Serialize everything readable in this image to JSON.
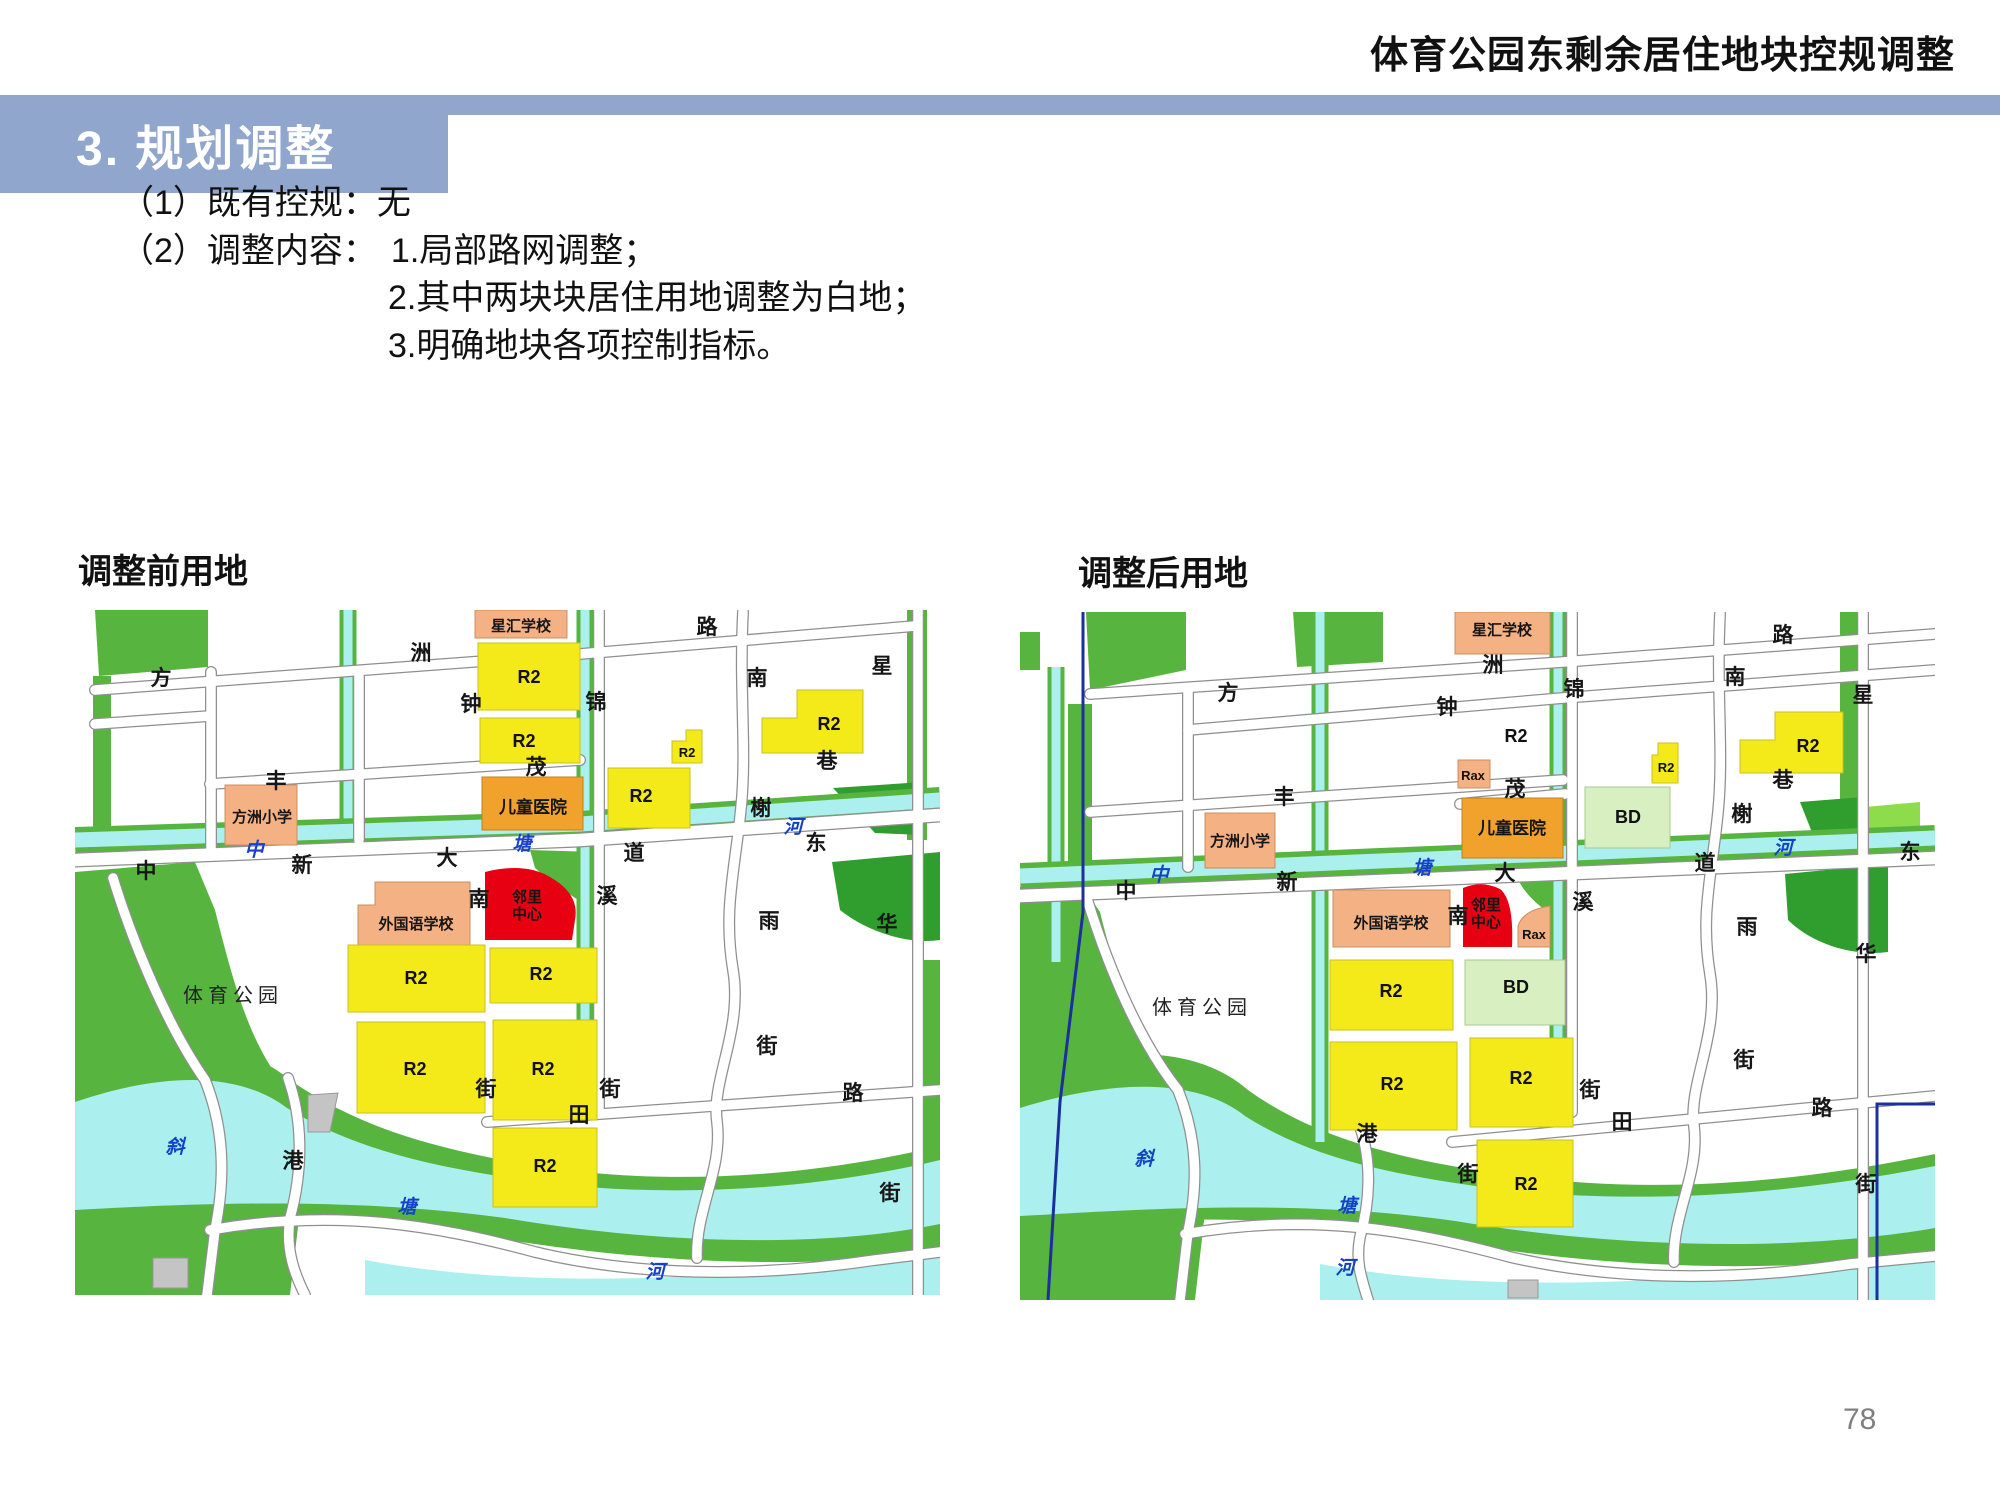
{
  "header": {
    "doc_title": "体育公园东剩余居住地块控规调整"
  },
  "section_banner": {
    "title": "3. 规划调整"
  },
  "body": {
    "line1": "（1）既有控规：无",
    "line2_prefix": "（2）调整内容：",
    "item1": "1.局部路网调整；",
    "item2": "2.其中两块块居住用地调整为白地；",
    "item3": "3.明确地块各项控制指标。"
  },
  "page_number": "78",
  "colors": {
    "banner_blue": "#90A6CC",
    "zone_residential_yellow": "#F4EA1A",
    "zone_school_orange": "#F4B183",
    "zone_hospital_amber": "#F0A22D",
    "zone_neighborhood_red": "#E60012",
    "zone_bd_pale_green": "#D8EFC2",
    "park_green": "#57B53F",
    "water_cyan": "#ABF0EF",
    "boundary_blue": "#1C2F9E"
  },
  "maps": {
    "before": {
      "caption": "调整前用地",
      "labels": [
        {
          "t": "方",
          "x": 86,
          "y": 75,
          "cls": "road-label",
          "name": "road-name-label"
        },
        {
          "t": "洲",
          "x": 346,
          "y": 50,
          "cls": "road-label",
          "name": "road-name-label"
        },
        {
          "t": "路",
          "x": 632,
          "y": 24,
          "cls": "road-label",
          "name": "road-name-label"
        },
        {
          "t": "南",
          "x": 682,
          "y": 75,
          "cls": "road-label",
          "name": "road-name-label"
        },
        {
          "t": "星",
          "x": 807,
          "y": 63,
          "cls": "road-label",
          "name": "road-name-label"
        },
        {
          "t": "钟",
          "x": 396,
          "y": 101,
          "cls": "road-label",
          "name": "road-name-label"
        },
        {
          "t": "锦",
          "x": 521,
          "y": 99,
          "cls": "road-label",
          "name": "road-name-label"
        },
        {
          "t": "丰",
          "x": 201,
          "y": 178,
          "cls": "road-label",
          "name": "road-name-label"
        },
        {
          "t": "茂",
          "x": 461,
          "y": 164,
          "cls": "road-label",
          "name": "road-name-label"
        },
        {
          "t": "巷",
          "x": 752,
          "y": 158,
          "cls": "road-label",
          "name": "road-name-label"
        },
        {
          "t": "中",
          "x": 71,
          "y": 268,
          "cls": "road-label",
          "name": "road-name-label"
        },
        {
          "t": "新",
          "x": 227,
          "y": 262,
          "cls": "road-label",
          "name": "road-name-label"
        },
        {
          "t": "大",
          "x": 372,
          "y": 255,
          "cls": "road-label",
          "name": "road-name-label"
        },
        {
          "t": "道",
          "x": 559,
          "y": 250,
          "cls": "road-label",
          "name": "road-name-label"
        },
        {
          "t": "东",
          "x": 741,
          "y": 240,
          "cls": "road-label",
          "name": "road-name-label"
        },
        {
          "t": "榭",
          "x": 686,
          "y": 205,
          "cls": "road-label",
          "name": "road-name-label"
        },
        {
          "t": "南",
          "x": 404,
          "y": 296,
          "cls": "road-label",
          "name": "road-name-label"
        },
        {
          "t": "溪",
          "x": 532,
          "y": 293,
          "cls": "road-label",
          "name": "road-name-label"
        },
        {
          "t": "雨",
          "x": 694,
          "y": 318,
          "cls": "road-label",
          "name": "road-name-label"
        },
        {
          "t": "华",
          "x": 812,
          "y": 321,
          "cls": "road-label",
          "name": "road-name-label"
        },
        {
          "t": "港",
          "x": 218,
          "y": 558,
          "cls": "road-label",
          "name": "road-name-label"
        },
        {
          "t": "街",
          "x": 411,
          "y": 486,
          "cls": "road-label",
          "name": "road-name-label"
        },
        {
          "t": "街",
          "x": 535,
          "y": 486,
          "cls": "road-label",
          "name": "road-name-label"
        },
        {
          "t": "田",
          "x": 504,
          "y": 512,
          "cls": "road-label",
          "name": "road-name-label"
        },
        {
          "t": "路",
          "x": 778,
          "y": 490,
          "cls": "road-label",
          "name": "road-name-label"
        },
        {
          "t": "街",
          "x": 692,
          "y": 443,
          "cls": "road-label",
          "name": "road-name-label"
        },
        {
          "t": "街",
          "x": 815,
          "y": 590,
          "cls": "road-label",
          "name": "road-name-label"
        },
        {
          "t": "中",
          "x": 179,
          "y": 246,
          "cls": "water-label",
          "name": "water-name-label"
        },
        {
          "t": "塘",
          "x": 447,
          "y": 240,
          "cls": "water-label",
          "name": "water-name-label"
        },
        {
          "t": "河",
          "x": 718,
          "y": 223,
          "cls": "water-label",
          "name": "water-name-label"
        },
        {
          "t": "斜",
          "x": 100,
          "y": 543,
          "cls": "water-label",
          "name": "water-name-label"
        },
        {
          "t": "塘",
          "x": 332,
          "y": 603,
          "cls": "water-label",
          "name": "water-name-label"
        },
        {
          "t": "河",
          "x": 580,
          "y": 668,
          "cls": "water-label",
          "name": "water-name-label"
        },
        {
          "t": "体育公园",
          "x": 158,
          "y": 392,
          "cls": "area-label",
          "name": "area-label"
        },
        {
          "t": "R2",
          "x": 454,
          "y": 73,
          "cls": "zone-label",
          "name": "zone-code-label"
        },
        {
          "t": "R2",
          "x": 449,
          "y": 137,
          "cls": "zone-label",
          "name": "zone-code-label"
        },
        {
          "t": "R2",
          "x": 612,
          "y": 147,
          "cls": "zone-label-sm",
          "name": "zone-code-label"
        },
        {
          "t": "R2",
          "x": 566,
          "y": 192,
          "cls": "zone-label",
          "name": "zone-code-label"
        },
        {
          "t": "R2",
          "x": 754,
          "y": 120,
          "cls": "zone-label",
          "name": "zone-code-label"
        },
        {
          "t": "R2",
          "x": 341,
          "y": 374,
          "cls": "zone-label",
          "name": "zone-code-label"
        },
        {
          "t": "R2",
          "x": 466,
          "y": 370,
          "cls": "zone-label",
          "name": "zone-code-label"
        },
        {
          "t": "R2",
          "x": 340,
          "y": 465,
          "cls": "zone-label",
          "name": "zone-code-label"
        },
        {
          "t": "R2",
          "x": 468,
          "y": 465,
          "cls": "zone-label",
          "name": "zone-code-label"
        },
        {
          "t": "R2",
          "x": 470,
          "y": 562,
          "cls": "zone-label",
          "name": "zone-code-label"
        },
        {
          "t": "星汇学校",
          "x": 446,
          "y": 21,
          "cls": "facility-label",
          "name": "facility-label"
        },
        {
          "t": "方洲小学",
          "x": 187,
          "y": 212,
          "cls": "facility-label",
          "name": "facility-label"
        },
        {
          "t": "外国语学校",
          "x": 341,
          "y": 319,
          "cls": "facility-label",
          "name": "facility-label"
        },
        {
          "t": "儿童医院",
          "x": 458,
          "y": 203,
          "cls": "facility-label-lg",
          "name": "facility-label"
        },
        {
          "t": "邻里",
          "x": 452,
          "y": 292,
          "cls": "facility-label",
          "name": "facility-label"
        },
        {
          "t": "中心",
          "x": 452,
          "y": 309,
          "cls": "facility-label",
          "name": "facility-label"
        }
      ]
    },
    "after": {
      "caption": "调整后用地",
      "labels": [
        {
          "t": "方",
          "x": 208,
          "y": 88,
          "cls": "road-label",
          "name": "road-name-label"
        },
        {
          "t": "洲",
          "x": 473,
          "y": 60,
          "cls": "road-label",
          "name": "road-name-label"
        },
        {
          "t": "路",
          "x": 763,
          "y": 30,
          "cls": "road-label",
          "name": "road-name-label"
        },
        {
          "t": "南",
          "x": 715,
          "y": 72,
          "cls": "road-label",
          "name": "road-name-label"
        },
        {
          "t": "星",
          "x": 843,
          "y": 90,
          "cls": "road-label",
          "name": "road-name-label"
        },
        {
          "t": "钟",
          "x": 427,
          "y": 102,
          "cls": "road-label",
          "name": "road-name-label"
        },
        {
          "t": "锦",
          "x": 554,
          "y": 84,
          "cls": "road-label",
          "name": "road-name-label"
        },
        {
          "t": "丰",
          "x": 264,
          "y": 192,
          "cls": "road-label",
          "name": "road-name-label"
        },
        {
          "t": "茂",
          "x": 495,
          "y": 184,
          "cls": "road-label",
          "name": "road-name-label"
        },
        {
          "t": "巷",
          "x": 763,
          "y": 175,
          "cls": "road-label",
          "name": "road-name-label"
        },
        {
          "t": "中",
          "x": 106,
          "y": 286,
          "cls": "road-label",
          "name": "road-name-label"
        },
        {
          "t": "新",
          "x": 267,
          "y": 277,
          "cls": "road-label",
          "name": "road-name-label"
        },
        {
          "t": "大",
          "x": 485,
          "y": 268,
          "cls": "road-label",
          "name": "road-name-label"
        },
        {
          "t": "道",
          "x": 685,
          "y": 258,
          "cls": "road-label",
          "name": "road-name-label"
        },
        {
          "t": "东",
          "x": 890,
          "y": 247,
          "cls": "road-label",
          "name": "road-name-label"
        },
        {
          "t": "榭",
          "x": 722,
          "y": 209,
          "cls": "road-label",
          "name": "road-name-label"
        },
        {
          "t": "南",
          "x": 438,
          "y": 311,
          "cls": "road-label",
          "name": "road-name-label"
        },
        {
          "t": "溪",
          "x": 563,
          "y": 297,
          "cls": "road-label",
          "name": "road-name-label"
        },
        {
          "t": "雨",
          "x": 727,
          "y": 322,
          "cls": "road-label",
          "name": "road-name-label"
        },
        {
          "t": "华",
          "x": 846,
          "y": 349,
          "cls": "road-label",
          "name": "road-name-label"
        },
        {
          "t": "港",
          "x": 347,
          "y": 529,
          "cls": "road-label",
          "name": "road-name-label"
        },
        {
          "t": "街",
          "x": 448,
          "y": 569,
          "cls": "road-label",
          "name": "road-name-label"
        },
        {
          "t": "街",
          "x": 570,
          "y": 485,
          "cls": "road-label",
          "name": "road-name-label"
        },
        {
          "t": "田",
          "x": 602,
          "y": 517,
          "cls": "road-label",
          "name": "road-name-label"
        },
        {
          "t": "路",
          "x": 802,
          "y": 503,
          "cls": "road-label",
          "name": "road-name-label"
        },
        {
          "t": "街",
          "x": 724,
          "y": 455,
          "cls": "road-label",
          "name": "road-name-label"
        },
        {
          "t": "街",
          "x": 846,
          "y": 579,
          "cls": "road-label",
          "name": "road-name-label"
        },
        {
          "t": "中",
          "x": 139,
          "y": 269,
          "cls": "water-label",
          "name": "water-name-label"
        },
        {
          "t": "塘",
          "x": 402,
          "y": 262,
          "cls": "water-label",
          "name": "water-name-label"
        },
        {
          "t": "河",
          "x": 763,
          "y": 242,
          "cls": "water-label",
          "name": "water-name-label"
        },
        {
          "t": "斜",
          "x": 124,
          "y": 553,
          "cls": "water-label",
          "name": "water-name-label"
        },
        {
          "t": "塘",
          "x": 327,
          "y": 600,
          "cls": "water-label",
          "name": "water-name-label"
        },
        {
          "t": "河",
          "x": 325,
          "y": 662,
          "cls": "water-label",
          "name": "water-name-label"
        },
        {
          "t": "体育公园",
          "x": 182,
          "y": 402,
          "cls": "area-label",
          "name": "area-label"
        },
        {
          "t": "R2",
          "x": 496,
          "y": 130,
          "cls": "zone-label",
          "name": "zone-code-label"
        },
        {
          "t": "Rax",
          "x": 453,
          "y": 168,
          "cls": "zone-label-sm",
          "name": "zone-code-label"
        },
        {
          "t": "R2",
          "x": 646,
          "y": 160,
          "cls": "zone-label-sm",
          "name": "zone-code-label"
        },
        {
          "t": "R2",
          "x": 788,
          "y": 140,
          "cls": "zone-label",
          "name": "zone-code-label"
        },
        {
          "t": "BD",
          "x": 608,
          "y": 211,
          "cls": "zone-label",
          "name": "zone-code-label"
        },
        {
          "t": "Rax",
          "x": 514,
          "y": 327,
          "cls": "zone-label-sm",
          "name": "zone-code-label"
        },
        {
          "t": "R2",
          "x": 371,
          "y": 385,
          "cls": "zone-label",
          "name": "zone-code-label"
        },
        {
          "t": "BD",
          "x": 496,
          "y": 381,
          "cls": "zone-label",
          "name": "zone-code-label"
        },
        {
          "t": "R2",
          "x": 372,
          "y": 478,
          "cls": "zone-label",
          "name": "zone-code-label"
        },
        {
          "t": "R2",
          "x": 501,
          "y": 472,
          "cls": "zone-label",
          "name": "zone-code-label"
        },
        {
          "t": "R2",
          "x": 506,
          "y": 578,
          "cls": "zone-label",
          "name": "zone-code-label"
        },
        {
          "t": "星汇学校",
          "x": 482,
          "y": 23,
          "cls": "facility-label",
          "name": "facility-label"
        },
        {
          "t": "方洲小学",
          "x": 220,
          "y": 234,
          "cls": "facility-label",
          "name": "facility-label"
        },
        {
          "t": "外国语学校",
          "x": 371,
          "y": 316,
          "cls": "facility-label",
          "name": "facility-label"
        },
        {
          "t": "儿童医院",
          "x": 492,
          "y": 222,
          "cls": "facility-label-lg",
          "name": "facility-label"
        },
        {
          "t": "邻里",
          "x": 466,
          "y": 298,
          "cls": "facility-label",
          "name": "facility-label"
        },
        {
          "t": "中心",
          "x": 466,
          "y": 315,
          "cls": "facility-label",
          "name": "facility-label"
        }
      ]
    }
  }
}
